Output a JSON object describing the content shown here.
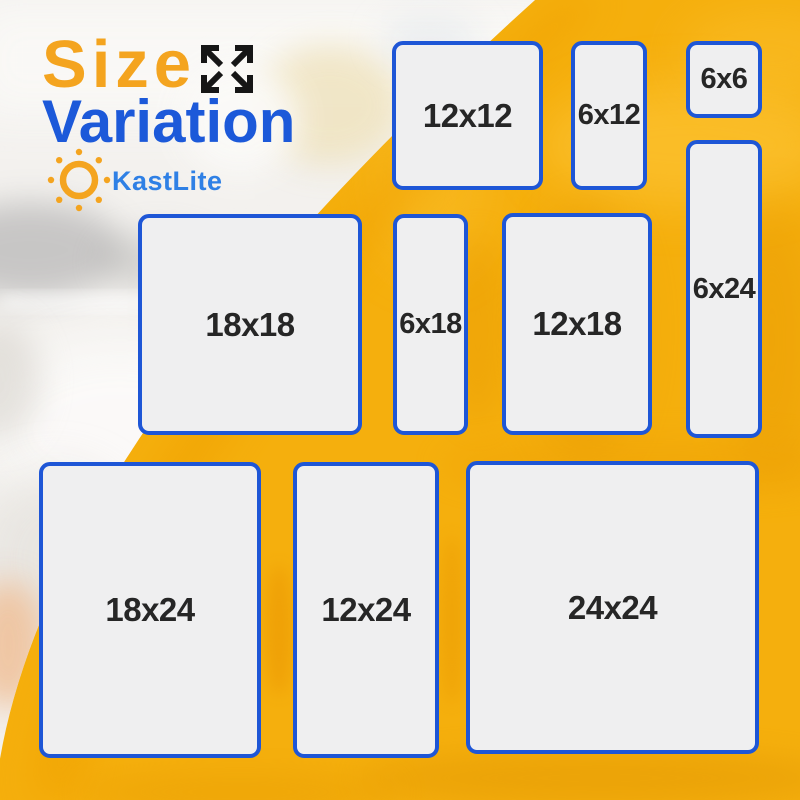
{
  "title": {
    "line1": "Size",
    "line2": "Variation"
  },
  "brand": {
    "name": "KastLite"
  },
  "icons": {
    "expand": "expand-arrows-icon",
    "sun": "sun-icon"
  },
  "sizes": [
    {
      "label": "12x12"
    },
    {
      "label": "6x12"
    },
    {
      "label": "6x6"
    },
    {
      "label": "6x24"
    },
    {
      "label": "18x18"
    },
    {
      "label": "6x18"
    },
    {
      "label": "12x18"
    },
    {
      "label": "18x24"
    },
    {
      "label": "12x24"
    },
    {
      "label": "24x24"
    }
  ],
  "theme": {
    "bg-yellow": "#F5AF0D",
    "accent-orange": "#F4A41F",
    "title-blue": "#1C59D9",
    "brand-blue": "#2F80E5",
    "tile-fill": "#EFEFF0",
    "tile-border": "#1E56D6",
    "label-dark": "#262626",
    "arrow-black": "#161616",
    "photo-white": "#F3F1EE"
  }
}
